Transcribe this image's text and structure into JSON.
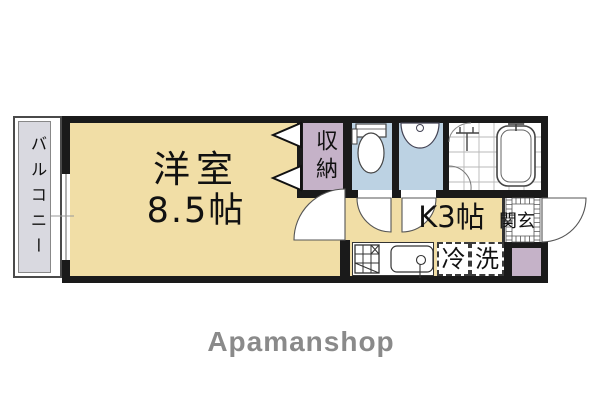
{
  "floorplan": {
    "balcony": {
      "label": "バルコニー"
    },
    "main_room": {
      "name": "洋室",
      "size": "8.5帖"
    },
    "closet": {
      "label": "収納"
    },
    "kitchen": {
      "label": "K3帖"
    },
    "entrance": {
      "label": "玄関"
    },
    "refrigerator": {
      "label": "冷"
    },
    "washing_machine": {
      "label": "洗"
    },
    "icons": {
      "toilet": "toilet-icon",
      "washbasin": "washbasin-icon",
      "bathtub": "bathtub-icon",
      "shower": "shower-faucet-icon",
      "stove": "stove-icon",
      "kitchen_sink": "kitchen-sink-icon",
      "door_swings": "door-swing-arc",
      "closet_doors": "closet-door-triangles",
      "window": "sliding-window"
    }
  },
  "branding": {
    "logo": "Apamanshop"
  },
  "colors": {
    "room_tan": "#F1DEA6",
    "closet_purple": "#C5B2C8",
    "wet_blue": "#BCD2E3",
    "balcony_gray": "#D9D9E0",
    "wall_black": "#1a1a1a",
    "logo_gray": "#8A8A8A"
  }
}
